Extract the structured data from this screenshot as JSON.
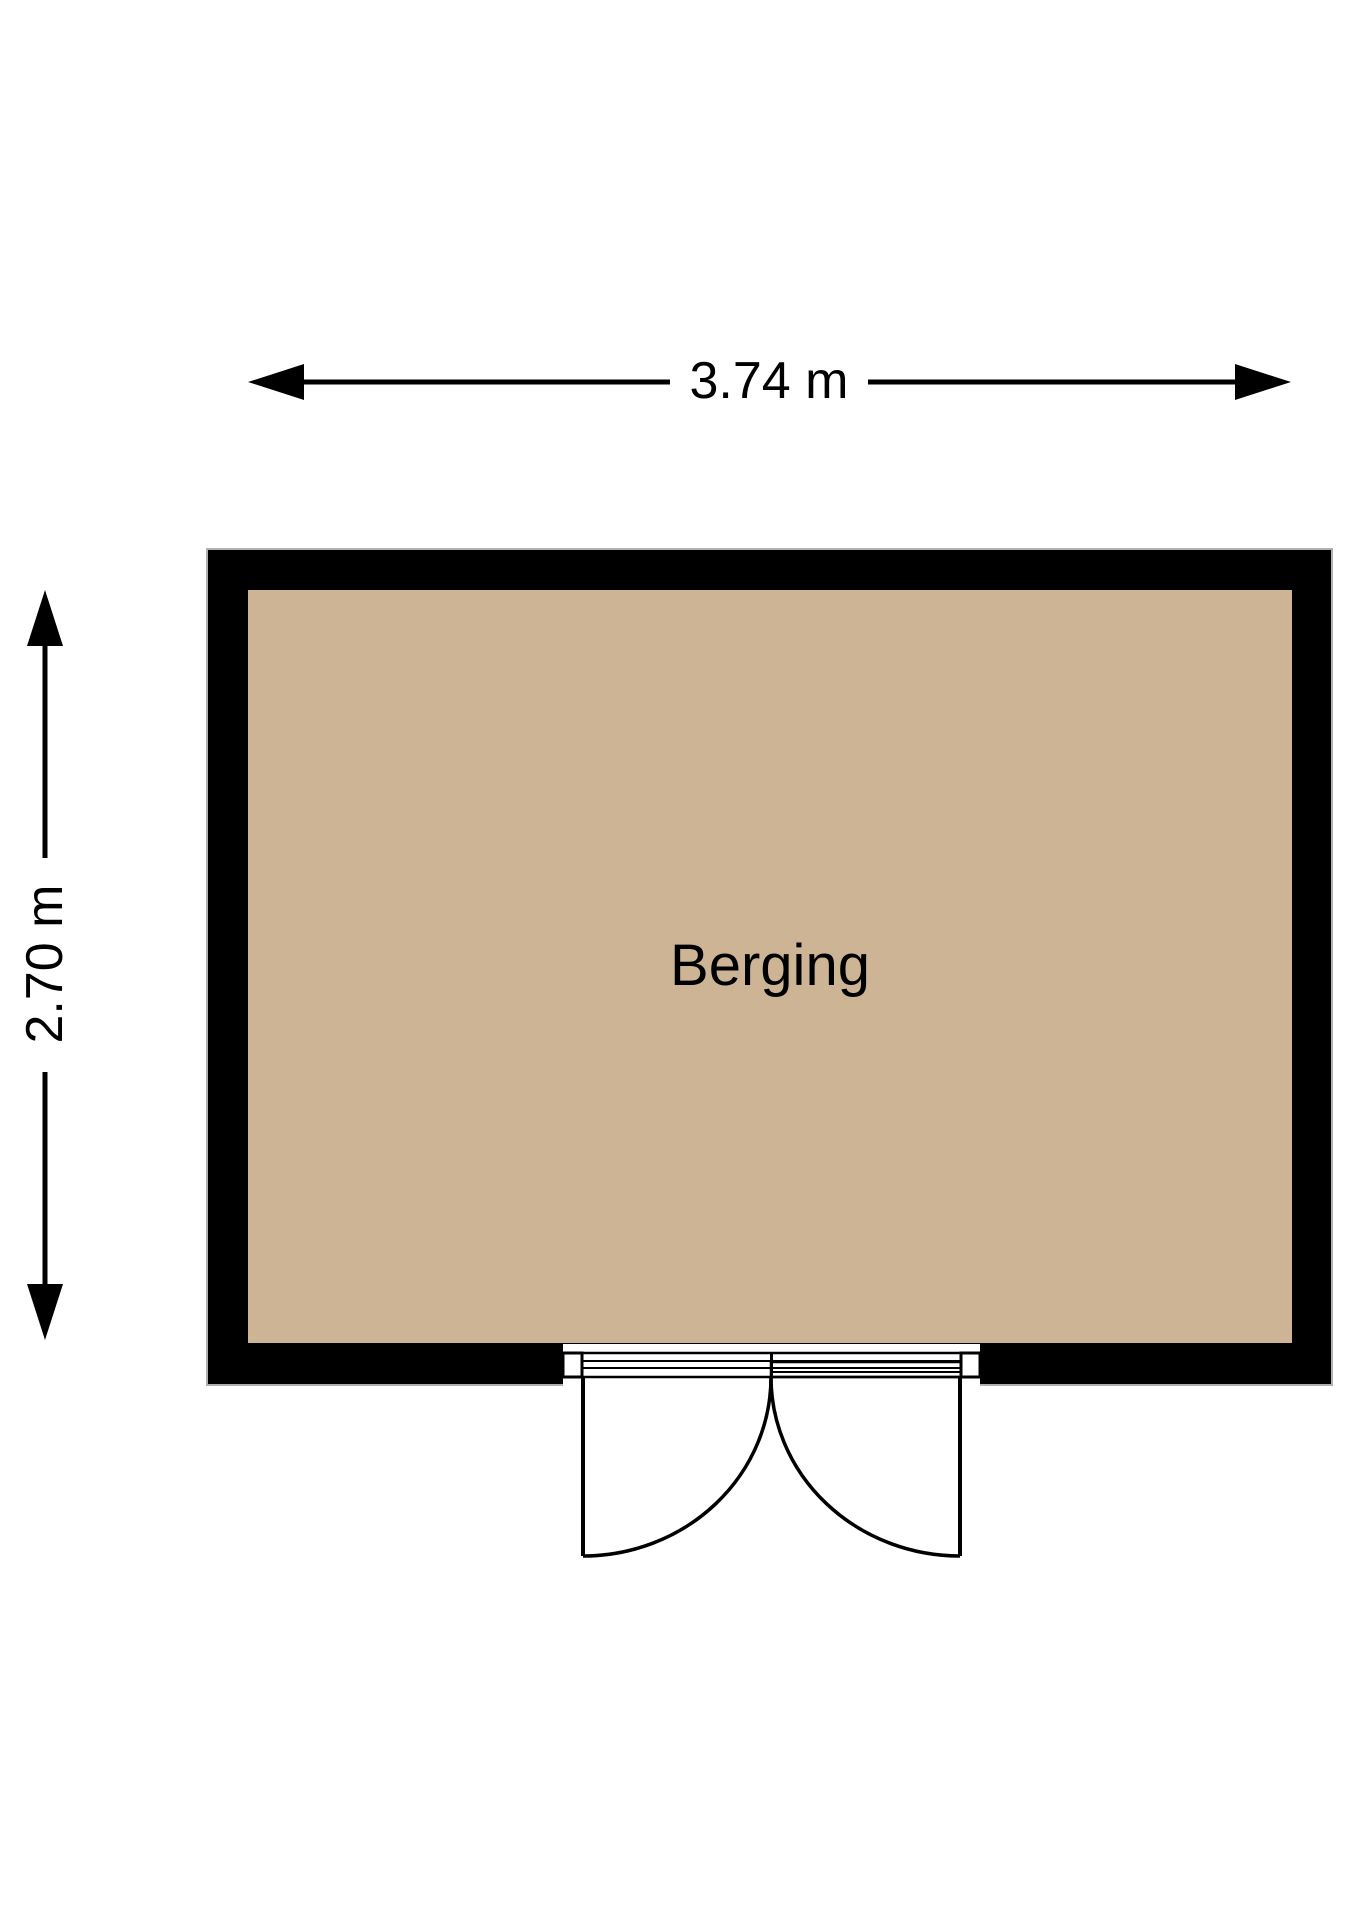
{
  "floorplan": {
    "background_color": "#ffffff",
    "wall_color": "#000000",
    "wall_outline_color": "#b0b0b0",
    "line_color": "#000000",
    "room": {
      "label": "Berging",
      "fill_color": "#ccb495"
    },
    "dimensions": {
      "width": {
        "label": "3.74 m"
      },
      "height": {
        "label": "2.70 m"
      }
    }
  }
}
